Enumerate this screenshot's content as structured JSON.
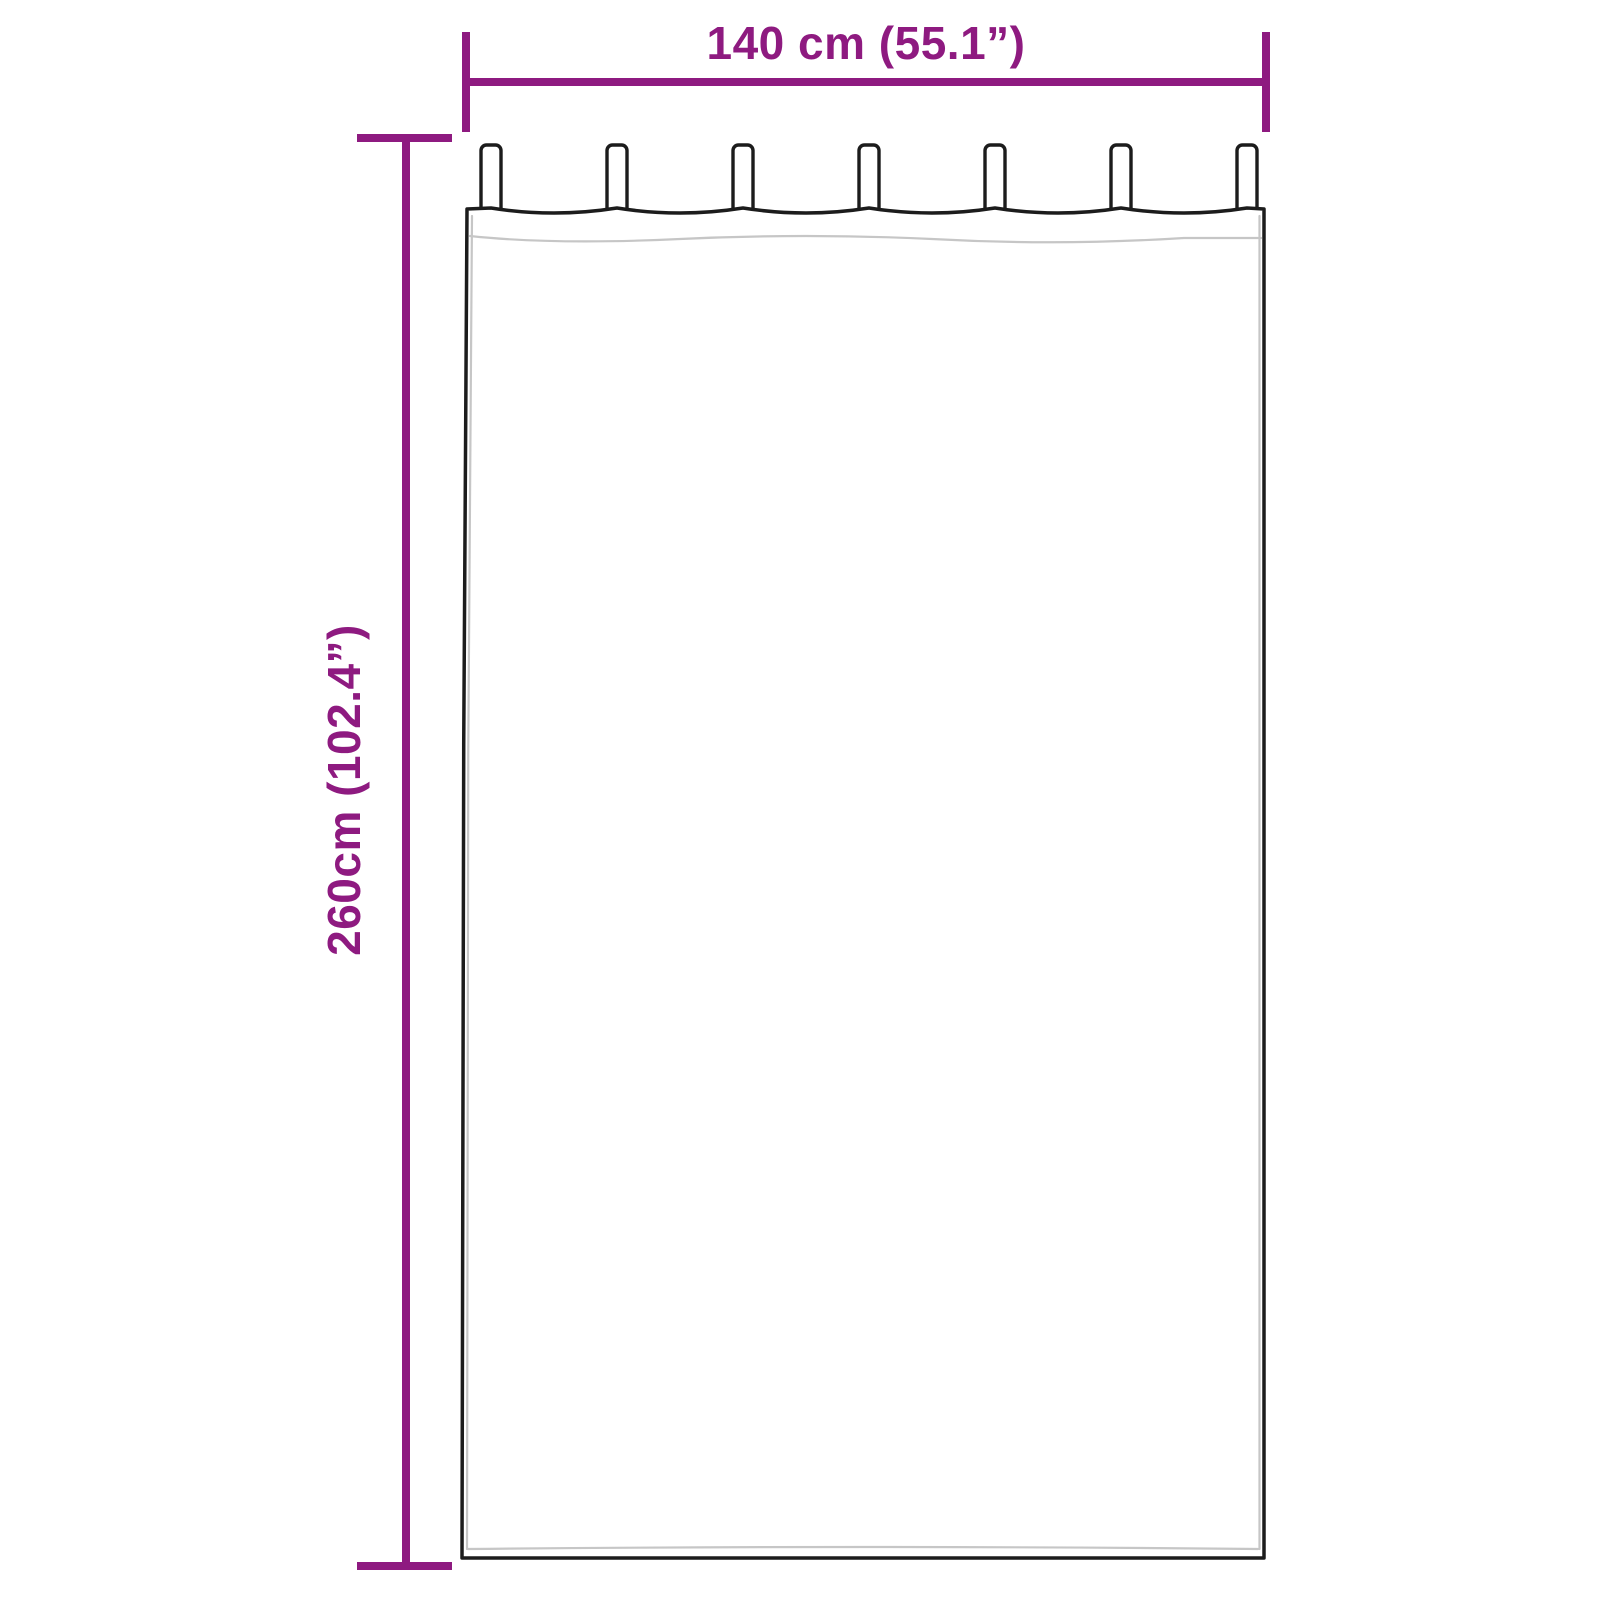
{
  "colors": {
    "dimension": "#8e1a80",
    "outline": "#1c1c1c",
    "hem": "#c6c6c6",
    "fabric": "#ffffff",
    "background": "#ffffff"
  },
  "diagram": {
    "type": "product-dimension-diagram",
    "product": "tab-top-curtain",
    "tab_count": 7,
    "width_label": "140 cm (55.1”)",
    "height_label": "260cm (102.4”)"
  }
}
